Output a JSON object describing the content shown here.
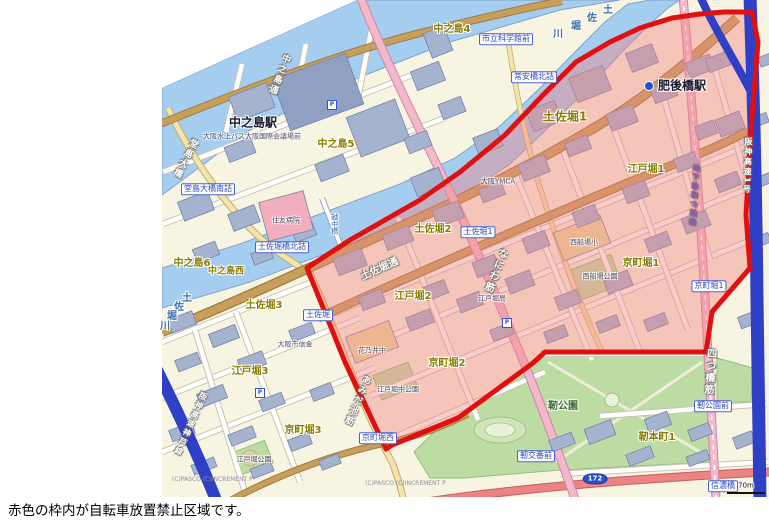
{
  "caption": "赤色の枠内が自転車放置禁止区域です。",
  "legend": {
    "zone_line_color": "#E01010",
    "zone_fill_color": "rgba(242,132,132,0.42)"
  },
  "map": {
    "copyright": "(C)PASCO (C)INCREMENT P",
    "copyright_positions": [
      [
        172,
        480
      ],
      [
        365,
        484
      ]
    ],
    "scale": {
      "label": "70m",
      "x": 746,
      "y": 486,
      "bar_x": 727,
      "bar_y": 492
    },
    "route_shield": {
      "num": "172",
      "x": 595,
      "y": 479
    },
    "icons": {
      "parking_glyph": "P"
    },
    "parking_icons": [
      [
        332,
        105
      ],
      [
        507,
        323
      ],
      [
        260,
        393
      ]
    ],
    "metro_icon": {
      "x": 649,
      "y": 86
    },
    "area_labels": [
      {
        "t": "中之島4",
        "x": 452,
        "y": 30
      },
      {
        "t": "中之島5",
        "x": 336,
        "y": 145
      },
      {
        "t": "中之島6",
        "x": 192,
        "y": 264
      },
      {
        "t": "中之島西",
        "x": 226,
        "y": 272,
        "fs": 9
      },
      {
        "t": "土佐堀1",
        "x": 565,
        "y": 117,
        "fs": 12
      },
      {
        "t": "土佐堀2",
        "x": 433,
        "y": 230
      },
      {
        "t": "土佐堀3",
        "x": 264,
        "y": 306
      },
      {
        "t": "江戸堀1",
        "x": 646,
        "y": 170
      },
      {
        "t": "江戸堀2",
        "x": 413,
        "y": 297
      },
      {
        "t": "江戸堀3",
        "x": 250,
        "y": 372
      },
      {
        "t": "京町堀1",
        "x": 641,
        "y": 264
      },
      {
        "t": "京町堀2",
        "x": 447,
        "y": 364
      },
      {
        "t": "京町堀3",
        "x": 303,
        "y": 431
      },
      {
        "t": "靭本町1",
        "x": 657,
        "y": 438
      }
    ],
    "station_labels": [
      {
        "t": "中之島駅",
        "x": 253,
        "y": 123
      },
      {
        "t": "肥後橋駅",
        "x": 682,
        "y": 86
      }
    ],
    "stop_labels": [
      {
        "t": "市立科学館前",
        "x": 506,
        "y": 39
      },
      {
        "t": "常安橋北詰",
        "x": 534,
        "y": 77
      },
      {
        "t": "堂島大橋南詰",
        "x": 208,
        "y": 189
      },
      {
        "t": "土佐堀橋北詰",
        "x": 282,
        "y": 247
      },
      {
        "t": "土佐堀1",
        "x": 478,
        "y": 232
      },
      {
        "t": "土佐堀",
        "x": 318,
        "y": 315
      },
      {
        "t": "京町堀1",
        "x": 709,
        "y": 286
      },
      {
        "t": "京町堀西",
        "x": 378,
        "y": 438
      },
      {
        "t": "靭公園前",
        "x": 713,
        "y": 406
      },
      {
        "t": "靭交番前",
        "x": 536,
        "y": 456
      },
      {
        "t": "信濃橋",
        "x": 723,
        "y": 486
      }
    ],
    "road_labels": [
      {
        "t": "中之島通",
        "x": 278,
        "y": 74,
        "vert": true,
        "rot": 22,
        "fs": 9
      },
      {
        "t": "土佐堀通",
        "x": 380,
        "y": 270,
        "vert": false,
        "rot": -24,
        "fs": 10
      },
      {
        "t": "なにわ筋",
        "x": 494,
        "y": 270,
        "vert": true,
        "rot": 22,
        "fs": 10
      },
      {
        "t": "あみだ池筋",
        "x": 356,
        "y": 400,
        "vert": true,
        "rot": 23,
        "fs": 9
      },
      {
        "t": "四つ橋筋",
        "x": 708,
        "y": 372,
        "vert": true,
        "rot": 4,
        "fs": 10
      },
      {
        "t": "地下鉄四つ橋線",
        "x": 694,
        "y": 196,
        "vert": true,
        "rot": 4,
        "fs": 7,
        "col": "#9A55BB"
      },
      {
        "t": "堂島大橋",
        "x": 184,
        "y": 158,
        "vert": true,
        "rot": 28,
        "fs": 9
      },
      {
        "t": "阪神高速1号",
        "x": 747,
        "y": 166,
        "vert": true,
        "rot": 2,
        "fs": 8
      },
      {
        "t": "阪神高速神戸線",
        "x": 190,
        "y": 424,
        "vert": true,
        "rot": 24,
        "fs": 8
      }
    ],
    "river_chars": [
      {
        "t": "土",
        "x": 608,
        "y": 11
      },
      {
        "t": "佐",
        "x": 592,
        "y": 19
      },
      {
        "t": "堀",
        "x": 576,
        "y": 27
      },
      {
        "t": "川",
        "x": 558,
        "y": 35
      },
      {
        "t": "土",
        "x": 187,
        "y": 299
      },
      {
        "t": "佐",
        "x": 179,
        "y": 308
      },
      {
        "t": "堀",
        "x": 172,
        "y": 317
      },
      {
        "t": "川",
        "x": 165,
        "y": 327
      }
    ],
    "bridge_labels": [
      {
        "t": "越中橋",
        "x": 334,
        "y": 224
      }
    ],
    "park_labels": [
      {
        "t": "靭公園",
        "x": 563,
        "y": 407
      }
    ],
    "poi_labels": [
      {
        "t": "住友病院",
        "x": 286,
        "y": 221
      },
      {
        "t": "大阪市信金",
        "x": 295,
        "y": 345
      },
      {
        "t": "花乃井中",
        "x": 372,
        "y": 351
      },
      {
        "t": "西船場小",
        "x": 584,
        "y": 243
      },
      {
        "t": "西船場公園",
        "x": 600,
        "y": 277
      },
      {
        "t": "江戸堀中公園",
        "x": 398,
        "y": 390
      },
      {
        "t": "江戸堀公園",
        "x": 254,
        "y": 460
      },
      {
        "t": "大阪YMCA",
        "x": 498,
        "y": 182
      },
      {
        "t": "江戸堀局",
        "x": 492,
        "y": 299
      },
      {
        "t": "大阪水上バス大阪国際会議場前",
        "x": 252,
        "y": 137
      }
    ]
  }
}
